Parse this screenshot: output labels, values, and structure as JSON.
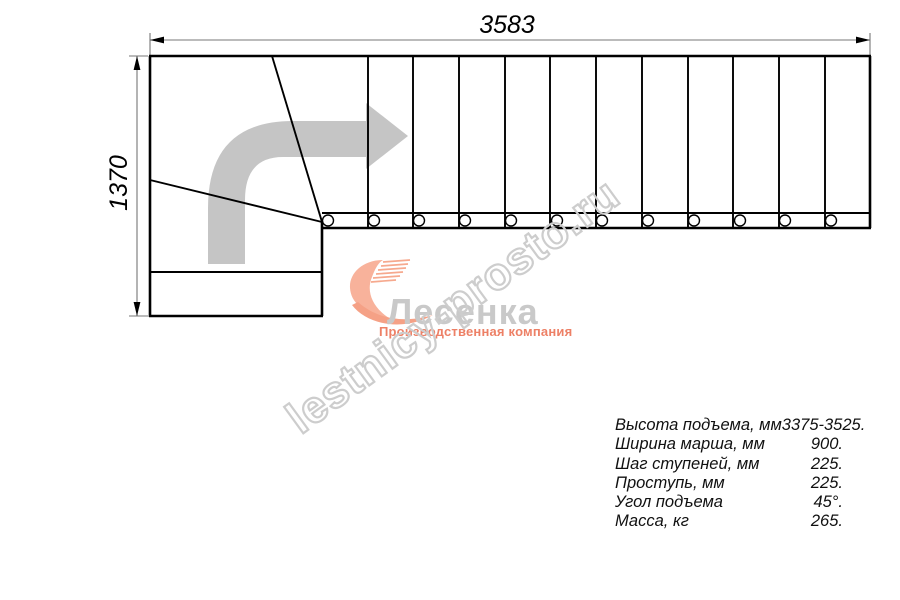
{
  "drawing": {
    "title": "staircase-plan-view",
    "width_dimension": "3583",
    "height_dimension": "1370",
    "straight_treads": 12,
    "winder_treads": 3,
    "direction": "up-then-turn-right"
  },
  "logo": {
    "name": "Лесенка",
    "subtitle": "Производственная компания"
  },
  "watermark": {
    "text": "lestnicy-prosto.ru"
  },
  "specs": {
    "rows": [
      {
        "label": "Высота подъема, мм",
        "value": "3375-3525."
      },
      {
        "label": "Ширина марша, мм",
        "value": "900."
      },
      {
        "label": "Шаг ступеней, мм",
        "value": "225."
      },
      {
        "label": "Проступь, мм",
        "value": "225."
      },
      {
        "label": "Угол подъема",
        "value": "45°."
      },
      {
        "label": "Масса, кг",
        "value": "265."
      }
    ]
  },
  "colors": {
    "outline": "#000000",
    "dimension_line": "#777777",
    "direction_arrow": "#c5c5c5",
    "watermark": "#cdcdcd",
    "logo_text": "#c9c9c9",
    "logo_accent": "#ed8066",
    "logo_swoosh": "#f8b29b"
  }
}
